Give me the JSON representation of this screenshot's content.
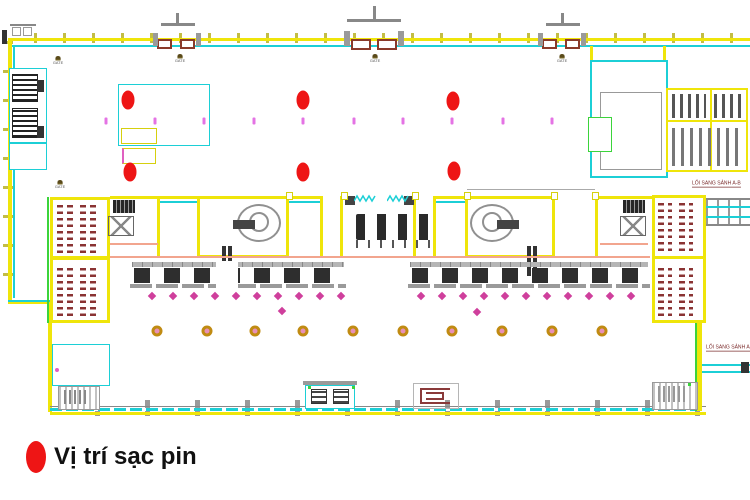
{
  "legend": {
    "label": "Vị trí sạc pin"
  },
  "labels": {
    "gates": [
      {
        "text": "GATE",
        "x": 58,
        "y": 56
      },
      {
        "text": "GATE",
        "x": 180,
        "y": 54
      },
      {
        "text": "GATE",
        "x": 375,
        "y": 54
      },
      {
        "text": "GATE",
        "x": 562,
        "y": 54
      },
      {
        "text": "GATE",
        "x": 60,
        "y": 180
      }
    ],
    "corridors": [
      {
        "text": "LỐI SANG SẢNH A-B",
        "x": 692,
        "y": 181
      },
      {
        "text": "LỐI SANG SẢNH A-B",
        "x": 706,
        "y": 345
      }
    ]
  },
  "markers": {
    "charging_positions": [
      [
        128,
        100
      ],
      [
        303,
        100
      ],
      [
        453,
        101
      ],
      [
        130,
        172
      ],
      [
        303,
        172
      ],
      [
        454,
        171
      ]
    ],
    "pink_dashes": [
      [
        106,
        121
      ],
      [
        155,
        121
      ],
      [
        204,
        121
      ],
      [
        254,
        121
      ],
      [
        303,
        121
      ],
      [
        354,
        121
      ],
      [
        403,
        121
      ],
      [
        452,
        121
      ],
      [
        503,
        121
      ],
      [
        552,
        121
      ]
    ],
    "diamonds": [
      [
        152,
        296
      ],
      [
        173,
        296
      ],
      [
        194,
        296
      ],
      [
        215,
        296
      ],
      [
        236,
        296
      ],
      [
        257,
        296
      ],
      [
        278,
        296
      ],
      [
        299,
        296
      ],
      [
        320,
        296
      ],
      [
        341,
        296
      ],
      [
        421,
        296
      ],
      [
        442,
        296
      ],
      [
        463,
        296
      ],
      [
        484,
        296
      ],
      [
        505,
        296
      ],
      [
        526,
        296
      ],
      [
        547,
        296
      ],
      [
        568,
        296
      ],
      [
        589,
        296
      ],
      [
        610,
        296
      ],
      [
        631,
        296
      ],
      [
        282,
        311
      ],
      [
        477,
        312
      ]
    ],
    "gold_circles": [
      [
        157,
        331
      ],
      [
        207,
        331
      ],
      [
        255,
        331
      ],
      [
        303,
        331
      ],
      [
        353,
        331
      ],
      [
        403,
        331
      ],
      [
        452,
        331
      ],
      [
        502,
        331
      ],
      [
        552,
        331
      ],
      [
        602,
        331
      ]
    ]
  },
  "colors": {
    "charging_red": "#ee1515",
    "wall_yellow": "#efe50a",
    "wall_cyan": "#1ccfd6",
    "diamond_pink": "#cf3f9c",
    "dash_pink": "#e473e4",
    "gold_ring": "#c08b12",
    "accent_green": "#3bd43b",
    "corridor_text": "#7a2a2a"
  }
}
